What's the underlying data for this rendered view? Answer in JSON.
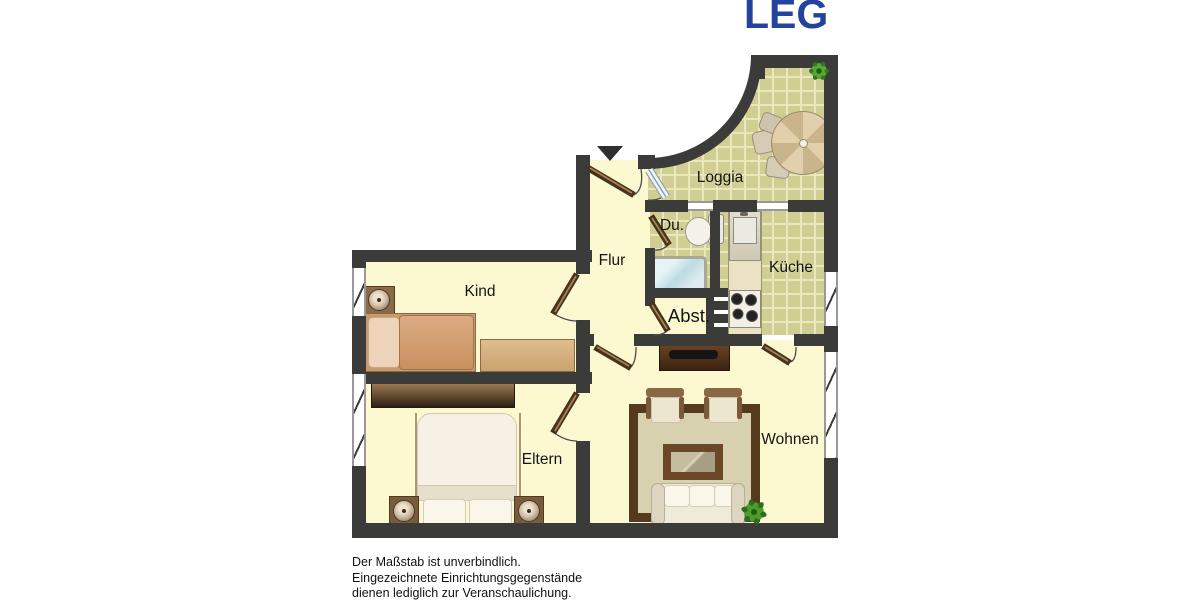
{
  "header": {
    "logo_text": "LEG",
    "logo_color": "#24439c"
  },
  "plan": {
    "type": "apartment-floor-plan",
    "rooms": [
      {
        "id": "loggia",
        "label": "Loggia"
      },
      {
        "id": "dusche",
        "label": "Du."
      },
      {
        "id": "kueche",
        "label": "Küche"
      },
      {
        "id": "flur",
        "label": "Flur"
      },
      {
        "id": "kind",
        "label": "Kind"
      },
      {
        "id": "abstellraum",
        "label": "Abst."
      },
      {
        "id": "eltern",
        "label": "Eltern"
      },
      {
        "id": "wohnen",
        "label": "Wohnen"
      }
    ],
    "colors": {
      "wall": "#3b3b39",
      "floor": "#fcf9d0",
      "tile": "#d0ce92",
      "tile_line": "#e9e7bc"
    }
  },
  "footer": {
    "disclaimer_lines": [
      "Der Maßstab ist unverbindlich.",
      "Eingezeichnete Einrichtungsgegenstände",
      "dienen lediglich zur Veranschaulichung."
    ]
  }
}
